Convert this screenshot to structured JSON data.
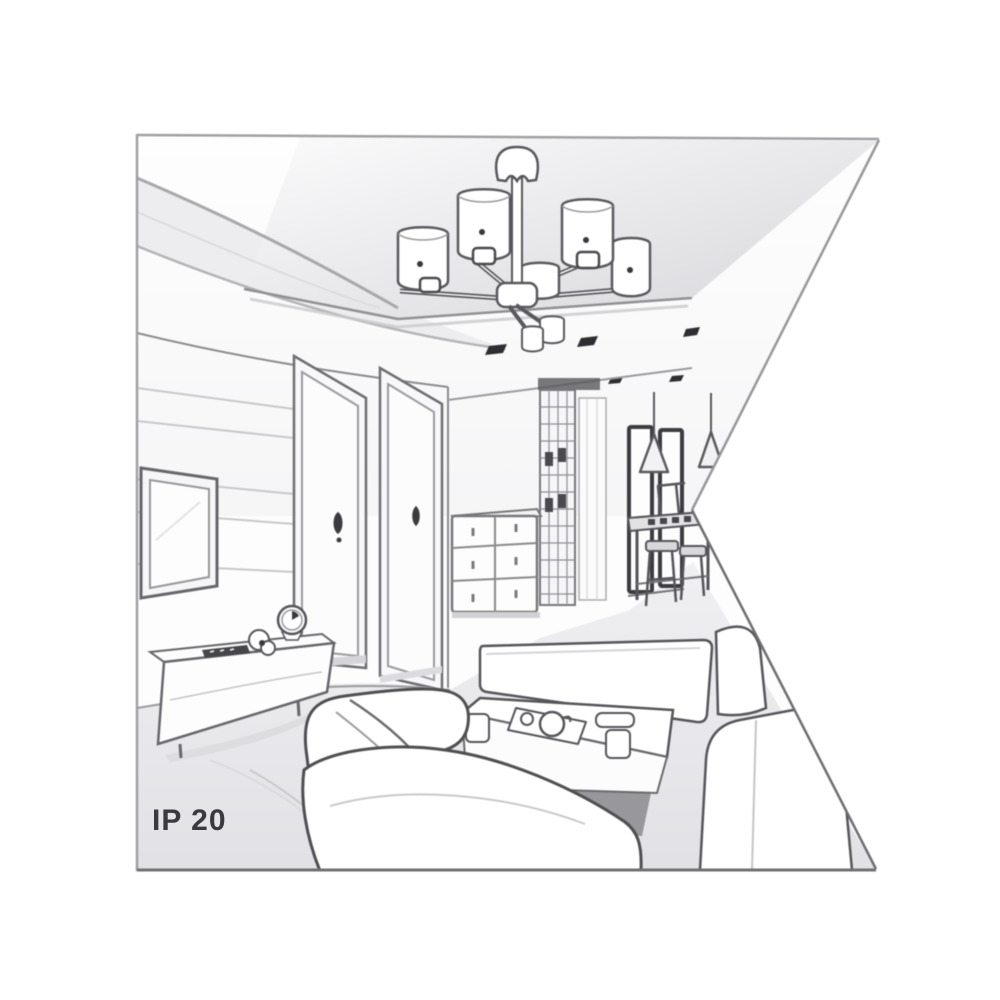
{
  "artwork": {
    "kind": "interior-room-perspective-line-drawing",
    "label": "IP 20",
    "palette": {
      "background": "#ffffff",
      "line": "#6b6b6e",
      "dark_line": "#46464a",
      "soft_line": "#b6b6b9",
      "floor": "#e7e7ea",
      "cove_shade": "#ededf0",
      "spotlight": "#2e2e32",
      "label_color": "#3a3a3e"
    },
    "scene": [
      "suspended ceiling panel",
      "multi-arm chandelier with cylindrical shades",
      "recessed ceiling spotlights",
      "wall mounted tv",
      "tv sideboard with clock and remote",
      "two interior doors",
      "chest of drawers",
      "hallway wardrobe",
      "dark window frames",
      "pendant cone lamps",
      "dining table with stools",
      "bench sofa",
      "corner sofa",
      "coffee table with tea set"
    ]
  }
}
